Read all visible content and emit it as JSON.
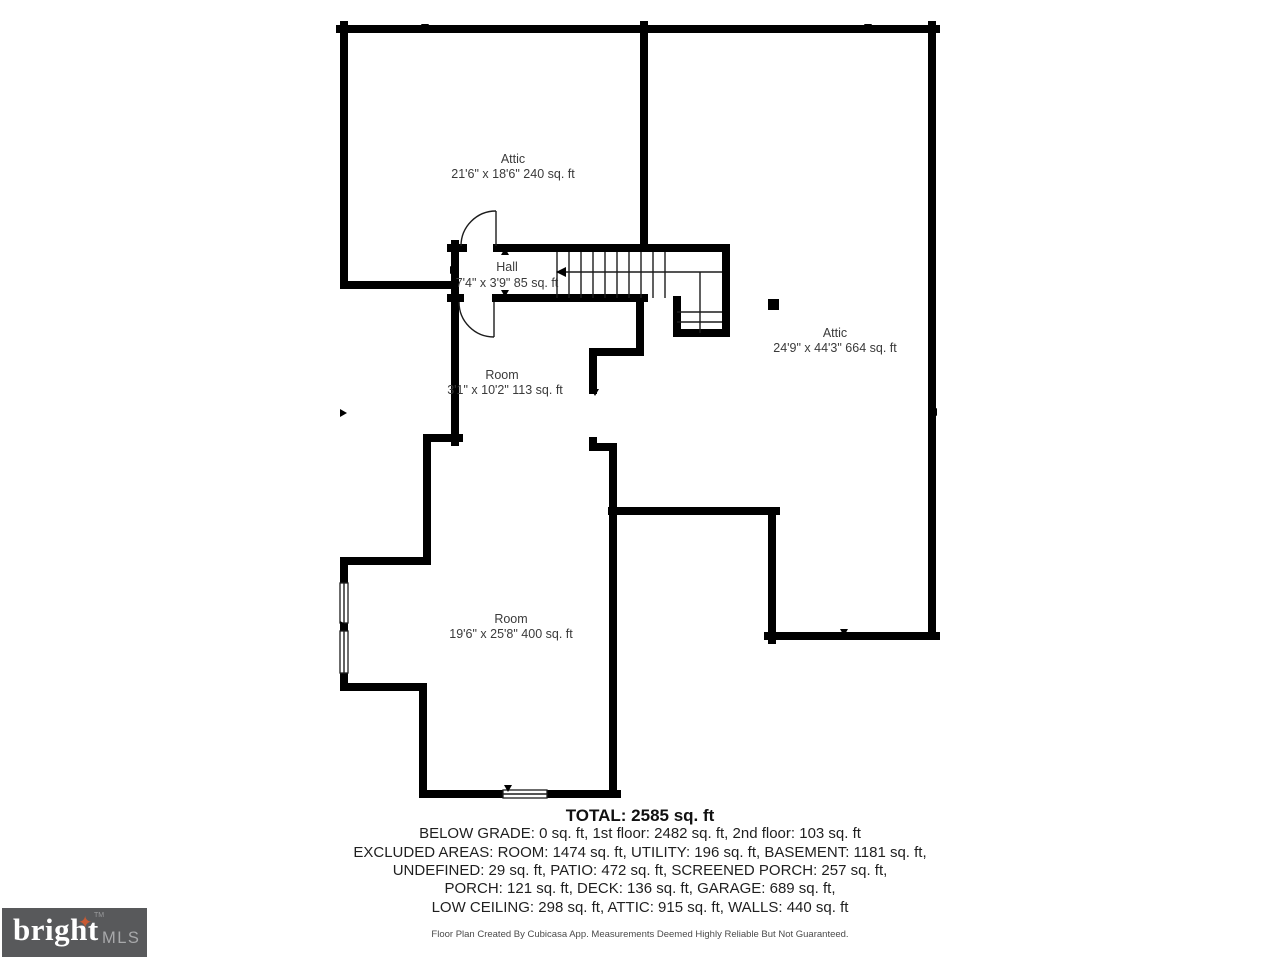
{
  "colors": {
    "wall": "#000000",
    "label": "#3a3a3a",
    "logobg": "#58595b",
    "brandcol": "#ffffff",
    "suffixcol": "#a8a9ab",
    "starcol": "#c85a33"
  },
  "floorplan": {
    "rooms": [
      {
        "name": "Attic",
        "dims": "21'6\" x 18'6\" 240 sq. ft"
      },
      {
        "name": "Hall",
        "dims": "7'4\" x 3'9\" 85 sq. ft"
      },
      {
        "name": "Attic",
        "dims": "24'9\" x 44'3\" 664 sq. ft"
      },
      {
        "name": "Room",
        "dims": "3'1\" x 10'2\" 113 sq. ft"
      },
      {
        "name": "Room",
        "dims": "19'6\" x 25'8\" 400 sq. ft"
      }
    ]
  },
  "summary": {
    "total": "TOTAL: 2585 sq. ft",
    "lines": [
      "BELOW GRADE: 0 sq. ft, 1st floor: 2482 sq. ft, 2nd floor: 103 sq. ft",
      "EXCLUDED AREAS: ROOM: 1474 sq. ft, UTILITY: 196 sq. ft, BASEMENT: 1181 sq. ft,",
      "UNDEFINED: 29 sq. ft, PATIO: 472 sq. ft, SCREENED PORCH: 257 sq. ft,",
      "PORCH: 121 sq. ft, DECK: 136 sq. ft, GARAGE: 689 sq. ft,",
      "LOW CEILING: 298 sq. ft, ATTIC: 915 sq. ft, WALLS: 440 sq. ft"
    ],
    "disclaimer": "Floor Plan Created By Cubicasa App. Measurements Deemed Highly Reliable But Not Guaranteed."
  },
  "logo": {
    "brand": "bright",
    "suffix": "MLS",
    "trademark": "TM",
    "star": "✦"
  }
}
